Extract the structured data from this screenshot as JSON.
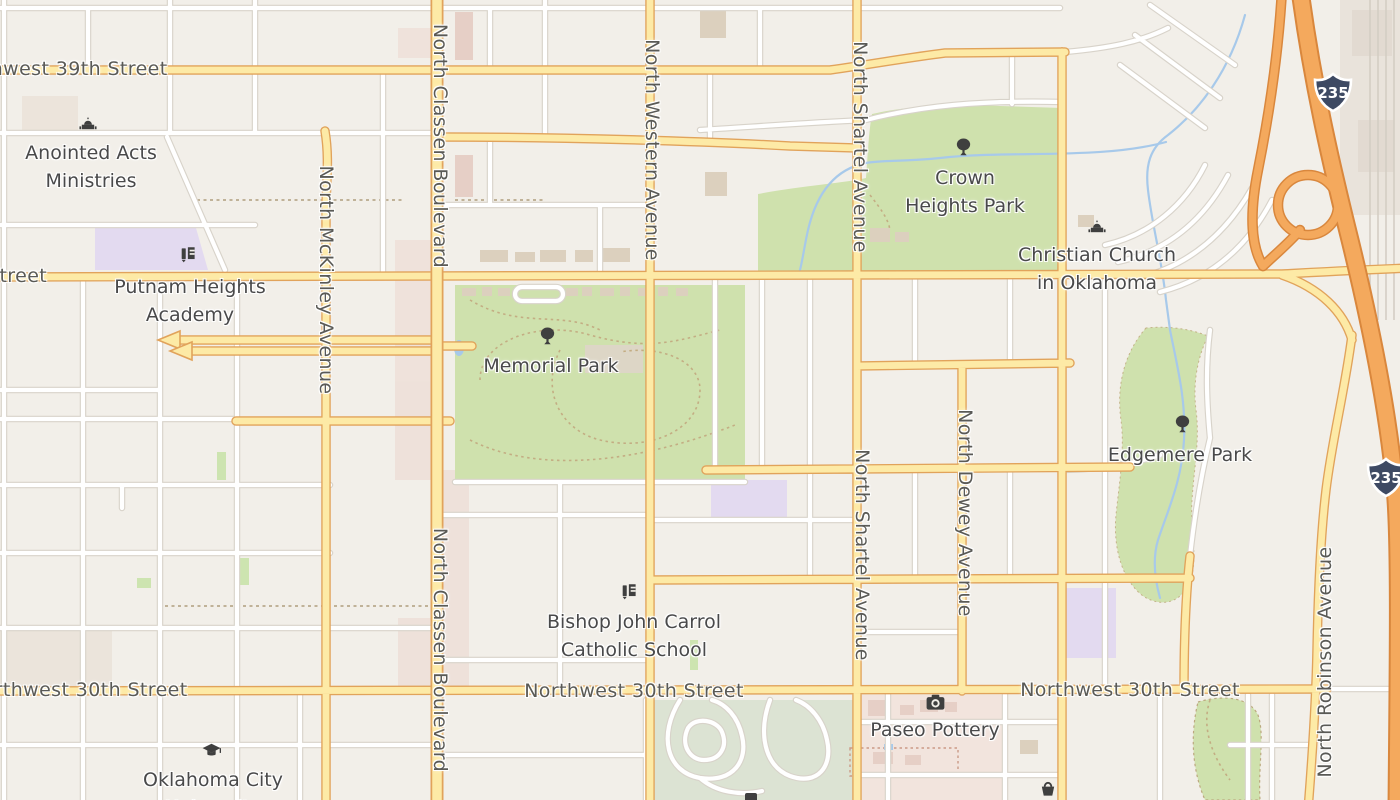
{
  "theme": {
    "land": "#f2efe9",
    "park": "#cfe1ad",
    "golf": "#dce3d3",
    "water": "#a7c9ea",
    "road_yellow": "#fdeaa6",
    "road_casing": "#e1a35b",
    "mw": "#f4a95d",
    "mw_casing": "#d9873d",
    "white_casing": "#d8d3ca",
    "icon": "#3f3f3f",
    "shield": "#3e4a63",
    "street_text": "#5a5a56",
    "poi_text": "#49494a"
  },
  "map": {
    "streets": {
      "northwest_39th": "Northwest 39th Street",
      "northwest_36th_fragment": "Street",
      "north_mckinley": "North McKinley Avenue",
      "north_classen": "North Classen Boulevard",
      "north_western": "North Western Avenue",
      "north_shartel": "North Shartel Avenue",
      "north_dewey": "North Dewey Avenue",
      "north_robinson": "North Robinson Avenue",
      "northwest_30th": "Northwest 30th Street"
    },
    "pois": {
      "anointed": {
        "line1": "Anointed Acts",
        "line2": "Ministries",
        "icon": "church-icon"
      },
      "putnam": {
        "line1": "Putnam Heights",
        "line2": "Academy",
        "icon": "school-icon"
      },
      "memorial_park": {
        "line1": "Memorial Park",
        "icon": "tree-icon"
      },
      "crown_heights": {
        "line1": "Crown",
        "line2": "Heights Park",
        "icon": "tree-icon"
      },
      "christian_church": {
        "line1": "Christian Church",
        "line2": "in Oklahoma",
        "icon": "church-icon"
      },
      "edgemere_park": {
        "line1": "Edgemere Park",
        "icon": "tree-icon"
      },
      "bishop_school": {
        "line1": "Bishop John Carrol",
        "line2": "Catholic School",
        "icon": "school-icon"
      },
      "paseo_pottery": {
        "line1": "Paseo Pottery",
        "icon": "camera-icon"
      },
      "okc_university": {
        "line1": "Oklahoma City",
        "line2": "University",
        "icon": "graduation-cap-icon"
      }
    },
    "shields": {
      "i235": "235"
    }
  }
}
